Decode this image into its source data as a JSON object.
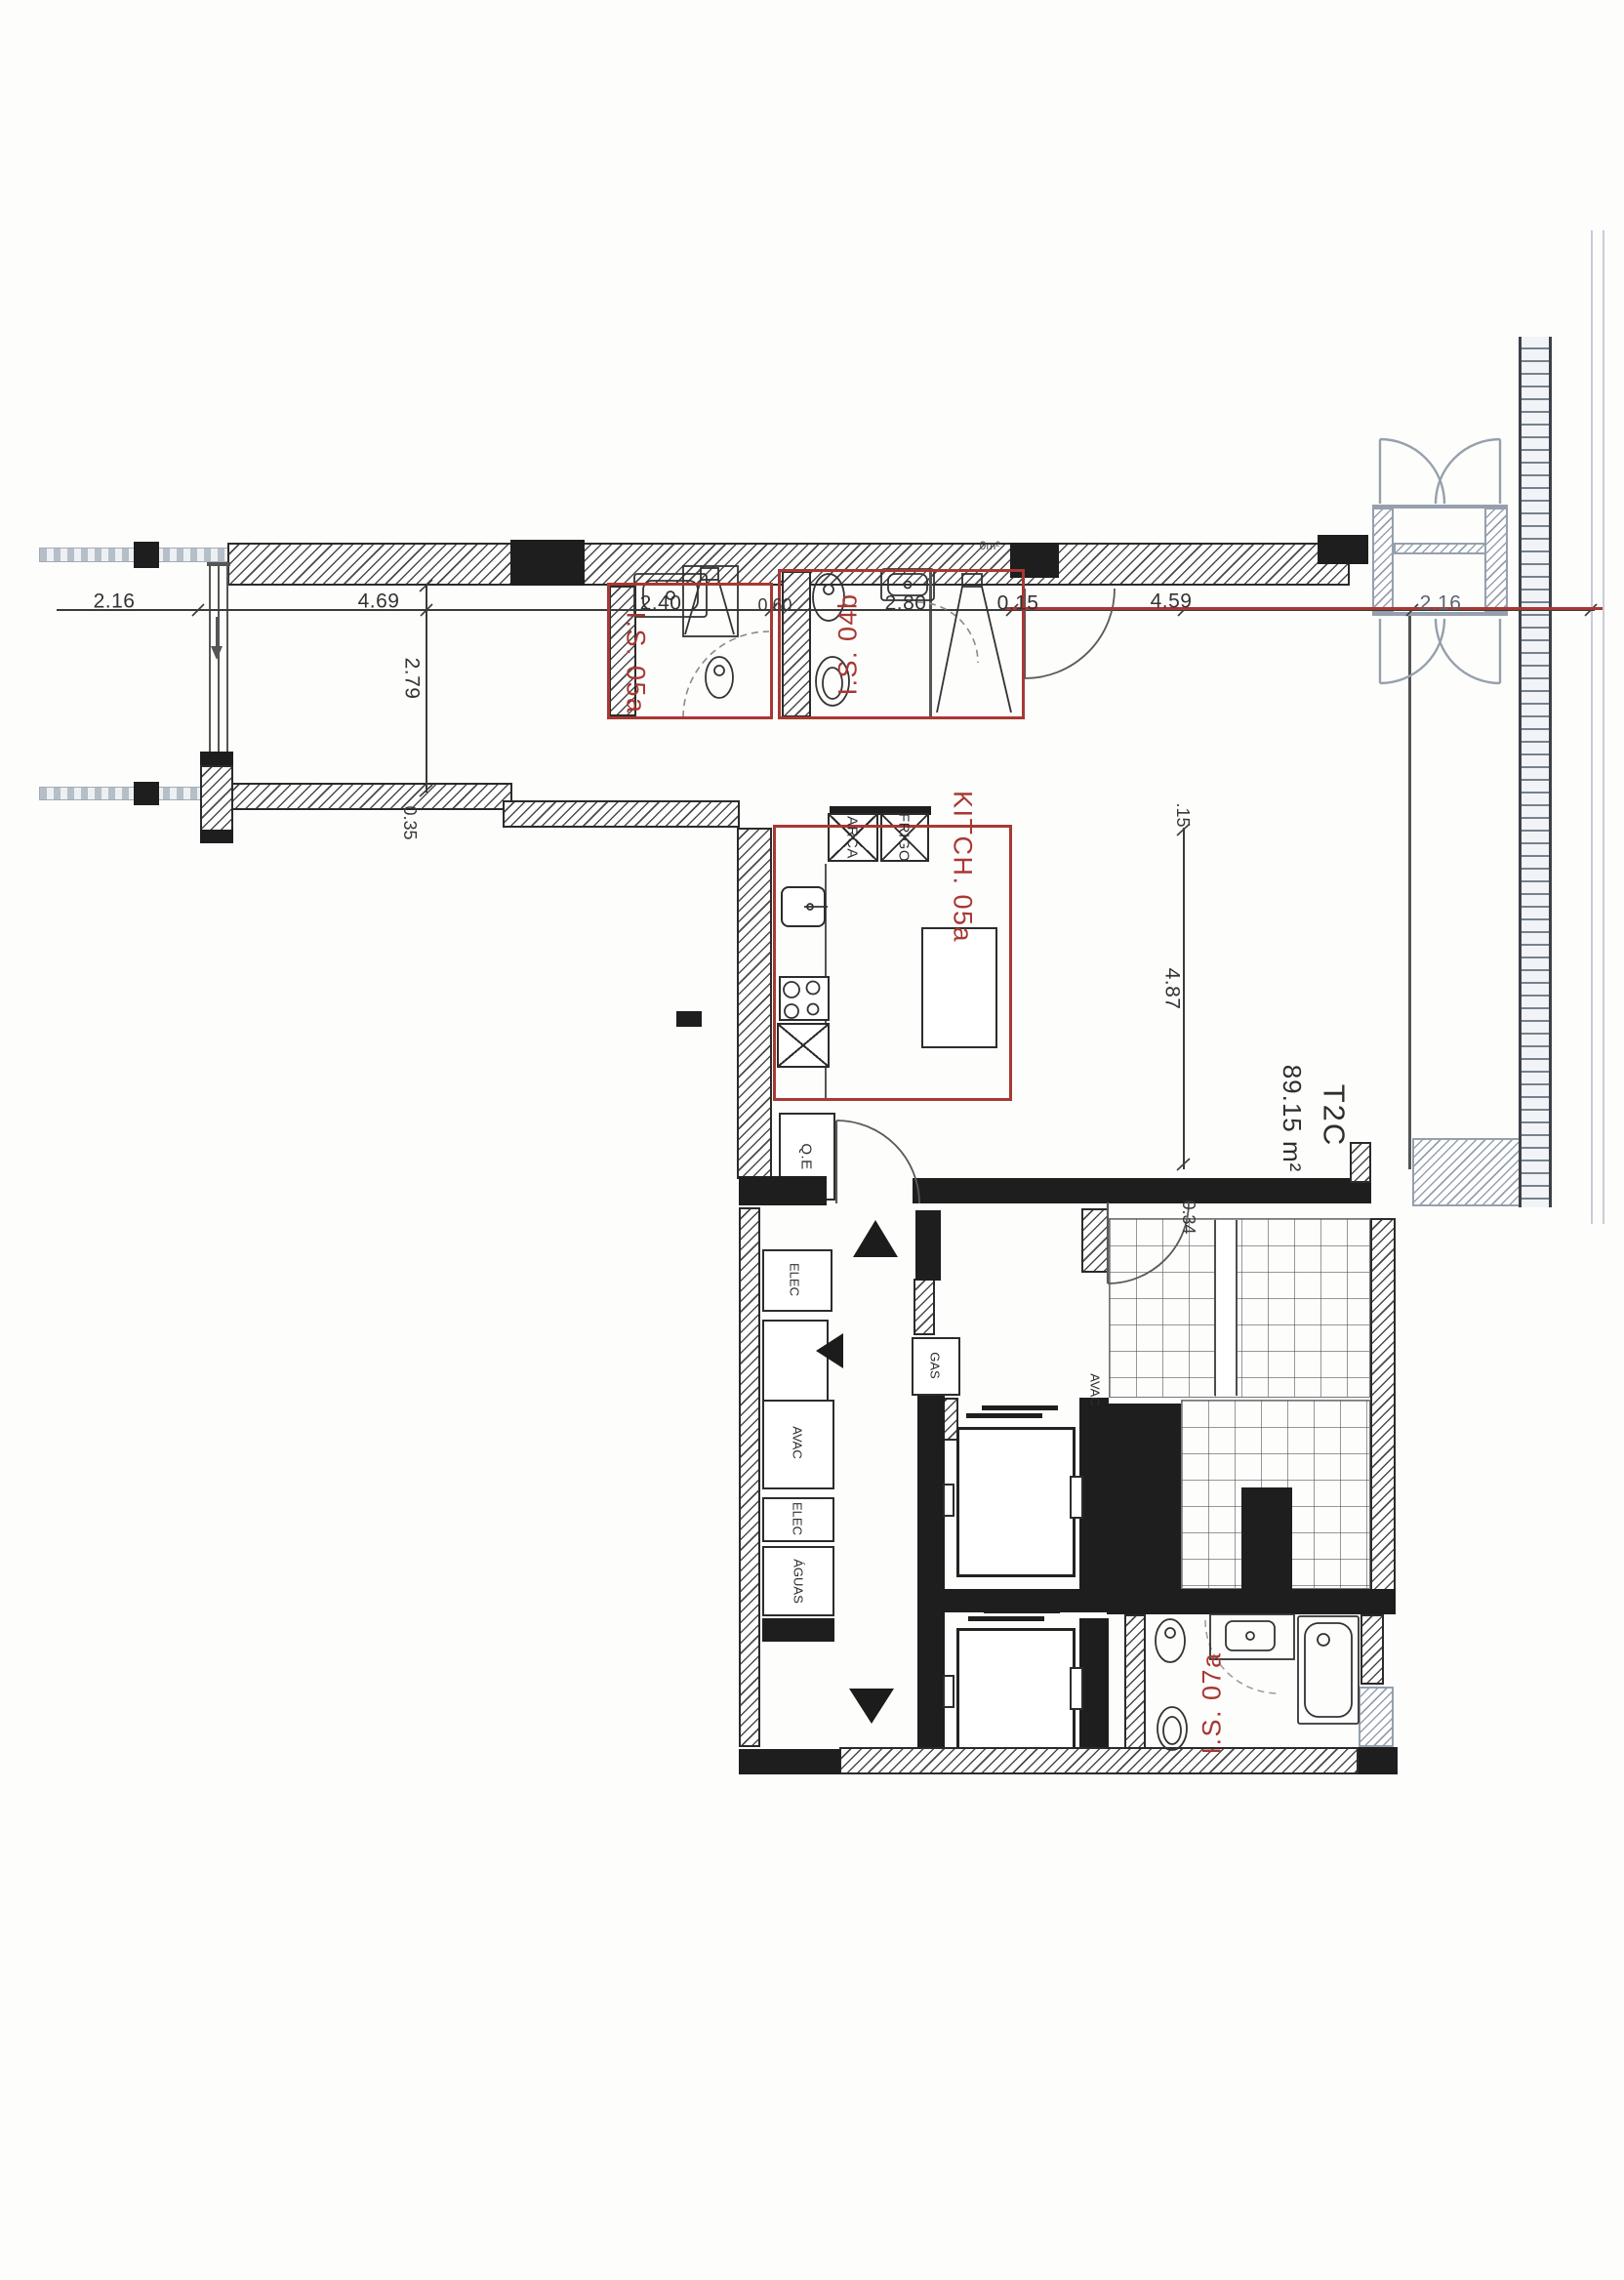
{
  "document": {
    "type": "architectural-floor-plan",
    "unit": {
      "code": "T2C",
      "area": "89.15 m²"
    }
  },
  "rooms": {
    "is05a": {
      "label": "I.S. 05a"
    },
    "is04b": {
      "label": "I.S. 04b"
    },
    "kitchen": {
      "label": "KITCH. 05a"
    },
    "is07a": {
      "label": "I.S. 07a"
    }
  },
  "dimensions": {
    "balcony_left": "2.16",
    "living_width": "4.69",
    "living_height": "2.79",
    "vanity_05a": "2.40",
    "door_gap": "0.60",
    "vanity_04b": "2.80",
    "wall_gap": "0.15",
    "main_width": "4.59",
    "entrance_width": "2.16",
    "wall_thickness": "0.35",
    "wall_offset": ".15",
    "main_height": "4.87",
    "stair_wall": "0.34",
    "area_note": "0m²"
  },
  "services": {
    "electrical_panel": "Q.E",
    "freezer": "ARCA",
    "fridge": "FRIGO",
    "gas": "GAS",
    "elec_shaft_top": "ELEC",
    "hvac_shaft": "AVAC",
    "elec_shaft_mid": "ELEC",
    "water_shaft": "ÁGUAS",
    "hvac_lobby": "AVAC"
  },
  "colors": {
    "annotation_red": "#a83832",
    "ink": "#2b2b2b",
    "gray_detail": "#96a0ac"
  }
}
